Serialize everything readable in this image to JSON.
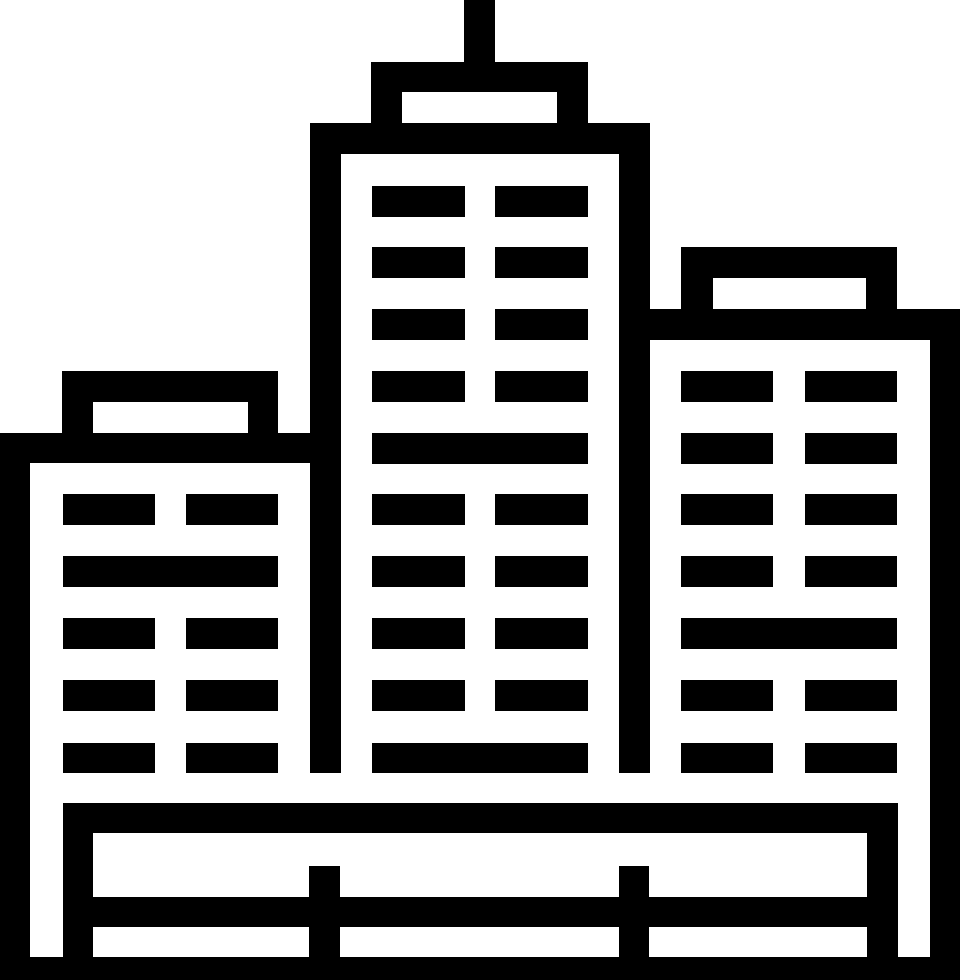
{
  "icon": {
    "name": "city-buildings",
    "description": "Monochrome line-art icon of a city skyline: tall center tower with antenna, shorter left building, mid-height right building, window bars, and a fenced base platform",
    "colors": {
      "foreground": "#000000",
      "background": "#ffffff"
    },
    "canvas": {
      "width": 960,
      "height": 980
    },
    "shapes": [
      {
        "name": "center-antenna",
        "x": 464,
        "y": 0,
        "w": 31,
        "h": 62
      },
      {
        "name": "center-cap-top",
        "x": 371,
        "y": 62,
        "w": 217,
        "h": 30
      },
      {
        "name": "center-cap-wall-left",
        "x": 371,
        "y": 92,
        "w": 31,
        "h": 31
      },
      {
        "name": "center-cap-wall-right",
        "x": 557,
        "y": 92,
        "w": 31,
        "h": 31
      },
      {
        "name": "center-roof",
        "x": 310,
        "y": 123,
        "w": 340,
        "h": 31
      },
      {
        "name": "center-wall-left",
        "x": 310,
        "y": 154,
        "w": 31,
        "h": 619
      },
      {
        "name": "center-wall-right",
        "x": 619,
        "y": 154,
        "w": 31,
        "h": 619
      },
      {
        "name": "center-window",
        "x": 372,
        "y": 186,
        "w": 93,
        "h": 31
      },
      {
        "name": "center-window",
        "x": 495,
        "y": 186,
        "w": 93,
        "h": 31
      },
      {
        "name": "center-window",
        "x": 372,
        "y": 247,
        "w": 93,
        "h": 31
      },
      {
        "name": "center-window",
        "x": 495,
        "y": 247,
        "w": 93,
        "h": 31
      },
      {
        "name": "center-window",
        "x": 372,
        "y": 309,
        "w": 93,
        "h": 31
      },
      {
        "name": "center-window",
        "x": 495,
        "y": 309,
        "w": 93,
        "h": 31
      },
      {
        "name": "center-window",
        "x": 372,
        "y": 371,
        "w": 93,
        "h": 31
      },
      {
        "name": "center-window",
        "x": 495,
        "y": 371,
        "w": 93,
        "h": 31
      },
      {
        "name": "center-window-wide",
        "x": 372,
        "y": 433,
        "w": 216,
        "h": 31
      },
      {
        "name": "center-window",
        "x": 372,
        "y": 494,
        "w": 93,
        "h": 31
      },
      {
        "name": "center-window",
        "x": 495,
        "y": 494,
        "w": 93,
        "h": 31
      },
      {
        "name": "center-window",
        "x": 372,
        "y": 556,
        "w": 93,
        "h": 31
      },
      {
        "name": "center-window",
        "x": 495,
        "y": 556,
        "w": 93,
        "h": 31
      },
      {
        "name": "center-window",
        "x": 372,
        "y": 618,
        "w": 93,
        "h": 31
      },
      {
        "name": "center-window",
        "x": 495,
        "y": 618,
        "w": 93,
        "h": 31
      },
      {
        "name": "center-window",
        "x": 372,
        "y": 680,
        "w": 93,
        "h": 31
      },
      {
        "name": "center-window",
        "x": 495,
        "y": 680,
        "w": 93,
        "h": 31
      },
      {
        "name": "center-window-wide",
        "x": 372,
        "y": 743,
        "w": 216,
        "h": 30
      },
      {
        "name": "left-cap-top",
        "x": 62,
        "y": 371,
        "w": 216,
        "h": 31
      },
      {
        "name": "left-cap-wall-left",
        "x": 62,
        "y": 402,
        "w": 31,
        "h": 31
      },
      {
        "name": "left-cap-wall-right",
        "x": 248,
        "y": 402,
        "w": 30,
        "h": 31
      },
      {
        "name": "left-roof",
        "x": 0,
        "y": 433,
        "w": 340,
        "h": 30
      },
      {
        "name": "left-wall-left",
        "x": 0,
        "y": 463,
        "w": 30,
        "h": 517
      },
      {
        "name": "left-window",
        "x": 63,
        "y": 494,
        "w": 92,
        "h": 31
      },
      {
        "name": "left-window",
        "x": 186,
        "y": 494,
        "w": 92,
        "h": 31
      },
      {
        "name": "left-window-wide",
        "x": 63,
        "y": 556,
        "w": 215,
        "h": 31
      },
      {
        "name": "left-window",
        "x": 63,
        "y": 618,
        "w": 92,
        "h": 31
      },
      {
        "name": "left-window",
        "x": 186,
        "y": 618,
        "w": 92,
        "h": 31
      },
      {
        "name": "left-window",
        "x": 63,
        "y": 680,
        "w": 92,
        "h": 31
      },
      {
        "name": "left-window",
        "x": 186,
        "y": 680,
        "w": 92,
        "h": 31
      },
      {
        "name": "left-window",
        "x": 63,
        "y": 743,
        "w": 92,
        "h": 30
      },
      {
        "name": "left-window",
        "x": 186,
        "y": 743,
        "w": 92,
        "h": 30
      },
      {
        "name": "right-cap-top",
        "x": 681,
        "y": 247,
        "w": 216,
        "h": 31
      },
      {
        "name": "right-cap-wall-left",
        "x": 681,
        "y": 278,
        "w": 32,
        "h": 31
      },
      {
        "name": "right-cap-wall-right",
        "x": 866,
        "y": 278,
        "w": 31,
        "h": 31
      },
      {
        "name": "right-roof",
        "x": 650,
        "y": 309,
        "w": 310,
        "h": 31
      },
      {
        "name": "right-wall-right",
        "x": 930,
        "y": 340,
        "w": 30,
        "h": 640
      },
      {
        "name": "right-window",
        "x": 681,
        "y": 371,
        "w": 92,
        "h": 31
      },
      {
        "name": "right-window",
        "x": 805,
        "y": 371,
        "w": 92,
        "h": 31
      },
      {
        "name": "right-window",
        "x": 681,
        "y": 433,
        "w": 92,
        "h": 31
      },
      {
        "name": "right-window",
        "x": 805,
        "y": 433,
        "w": 92,
        "h": 31
      },
      {
        "name": "right-window",
        "x": 681,
        "y": 494,
        "w": 92,
        "h": 31
      },
      {
        "name": "right-window",
        "x": 805,
        "y": 494,
        "w": 92,
        "h": 31
      },
      {
        "name": "right-window",
        "x": 681,
        "y": 556,
        "w": 92,
        "h": 31
      },
      {
        "name": "right-window",
        "x": 805,
        "y": 556,
        "w": 92,
        "h": 31
      },
      {
        "name": "right-window-wide",
        "x": 681,
        "y": 618,
        "w": 216,
        "h": 31
      },
      {
        "name": "right-window",
        "x": 681,
        "y": 680,
        "w": 92,
        "h": 31
      },
      {
        "name": "right-window",
        "x": 805,
        "y": 680,
        "w": 92,
        "h": 31
      },
      {
        "name": "right-window",
        "x": 681,
        "y": 743,
        "w": 92,
        "h": 30
      },
      {
        "name": "right-window",
        "x": 805,
        "y": 743,
        "w": 92,
        "h": 30
      },
      {
        "name": "base-top-bar",
        "x": 63,
        "y": 803,
        "w": 835,
        "h": 30
      },
      {
        "name": "base-wall-left",
        "x": 63,
        "y": 833,
        "w": 30,
        "h": 125
      },
      {
        "name": "base-wall-right",
        "x": 867,
        "y": 833,
        "w": 31,
        "h": 125
      },
      {
        "name": "base-rail",
        "x": 93,
        "y": 897,
        "w": 805,
        "h": 30
      },
      {
        "name": "base-post-left",
        "x": 309,
        "y": 866,
        "w": 31,
        "h": 92
      },
      {
        "name": "base-post-right",
        "x": 619,
        "y": 866,
        "w": 30,
        "h": 92
      },
      {
        "name": "base-bottom-bar",
        "x": 0,
        "y": 957,
        "w": 960,
        "h": 23
      }
    ]
  }
}
